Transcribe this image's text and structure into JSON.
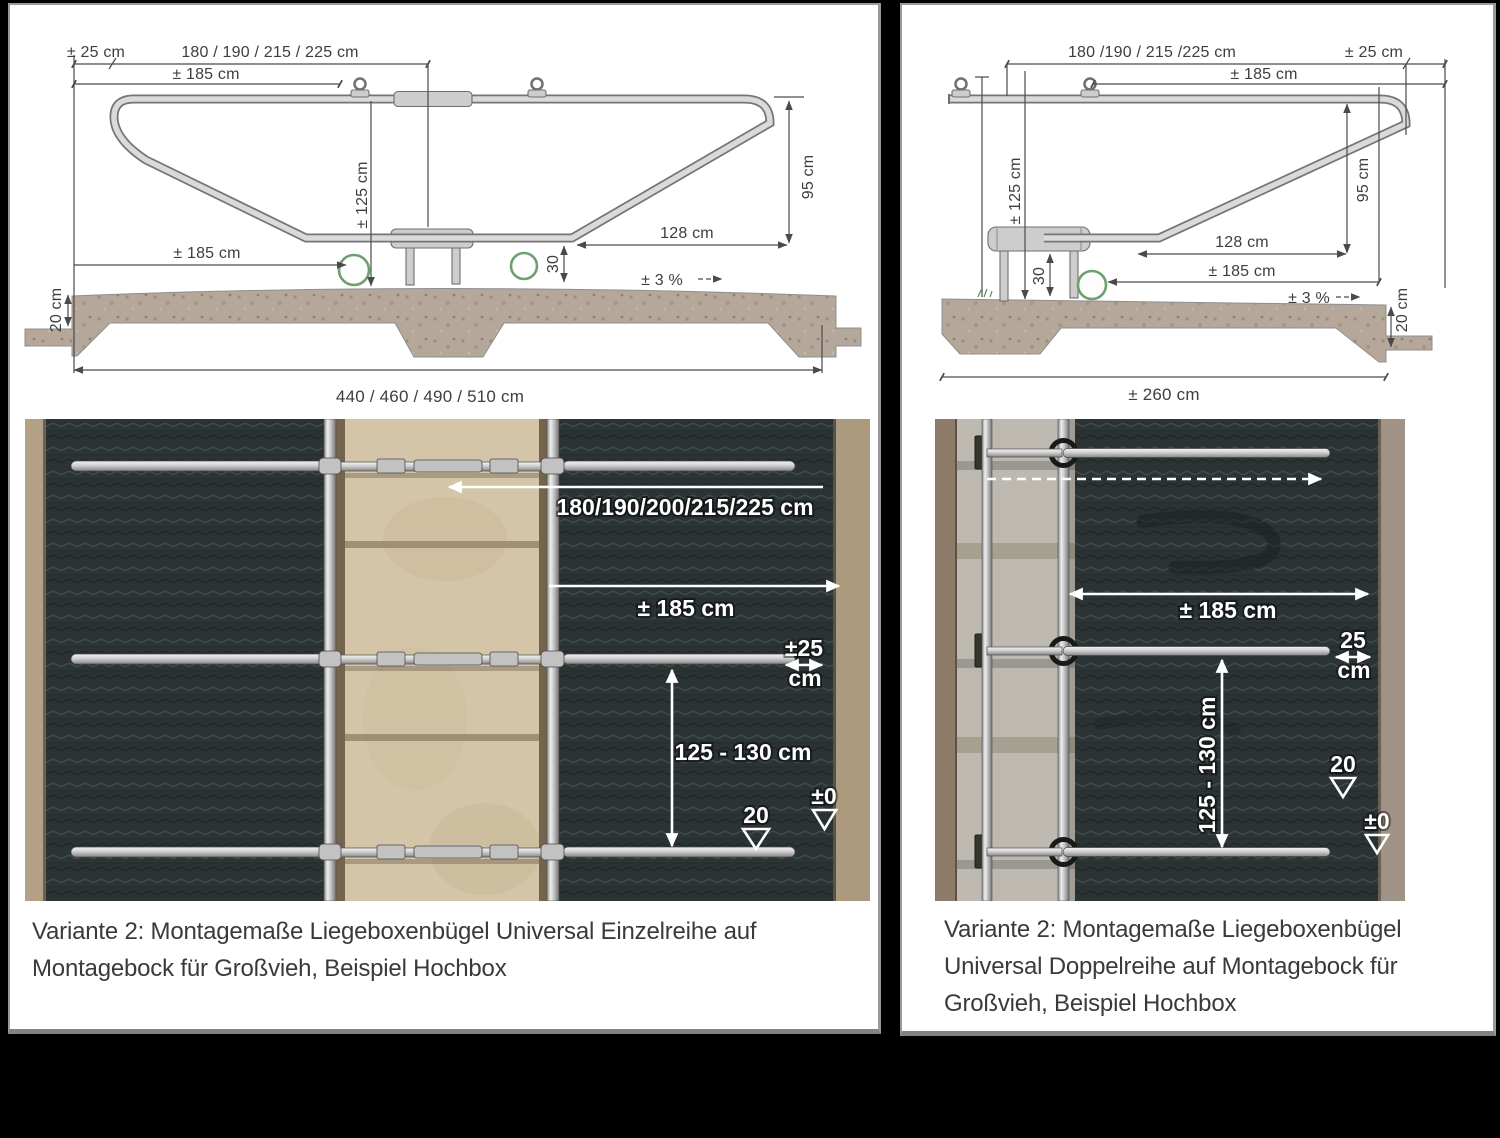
{
  "left": {
    "drawing": {
      "offset_25": "± 25 cm",
      "top_span": "180 / 190 / 215 / 225 cm",
      "span_185_top": "± 185 cm",
      "height_125": "± 125 cm",
      "height_95": "95 cm",
      "depth_128": "128 cm",
      "span_185_low": "± 185 cm",
      "height_30": "30",
      "slope": "± 3 %",
      "slab_20": "20 cm",
      "total_span": "440 / 460 / 490 / 510 cm"
    },
    "photo": {
      "widths": "180/190/200/215/225 cm",
      "span_185": "± 185 cm",
      "overlap_25": "±25",
      "overlap_25_unit": "cm",
      "length_range": "125 - 130 cm",
      "level_20": "20",
      "level_0": "±0"
    },
    "caption_lines": [
      "Variante 2: Montagemaße Liegeboxenbügel Universal Einzelreihe auf",
      "Montagebock für Großvieh, Beispiel Hochbox"
    ]
  },
  "right": {
    "drawing": {
      "top_span": "180 /190 / 215 /225 cm",
      "offset_25": "± 25 cm",
      "span_185_top": "± 185 cm",
      "height_125": "± 125 cm",
      "height_95": "95 cm",
      "depth_128": "128 cm",
      "span_185_low": "± 185 cm",
      "height_30": "30",
      "slope": "± 3 %",
      "slab_20": "20 cm",
      "total_span": "± 260 cm"
    },
    "photo": {
      "span_185": "± 185 cm",
      "overlap_25": "25",
      "overlap_25_unit": "cm",
      "length_range": "125 - 130 cm",
      "level_20": "20",
      "level_0": "±0"
    },
    "caption_lines": [
      "Variante 2: Montagemaße Liegeboxenbügel",
      "Universal Doppelreihe auf Montagebock für",
      "Großvieh, Beispiel Hochbox"
    ]
  }
}
